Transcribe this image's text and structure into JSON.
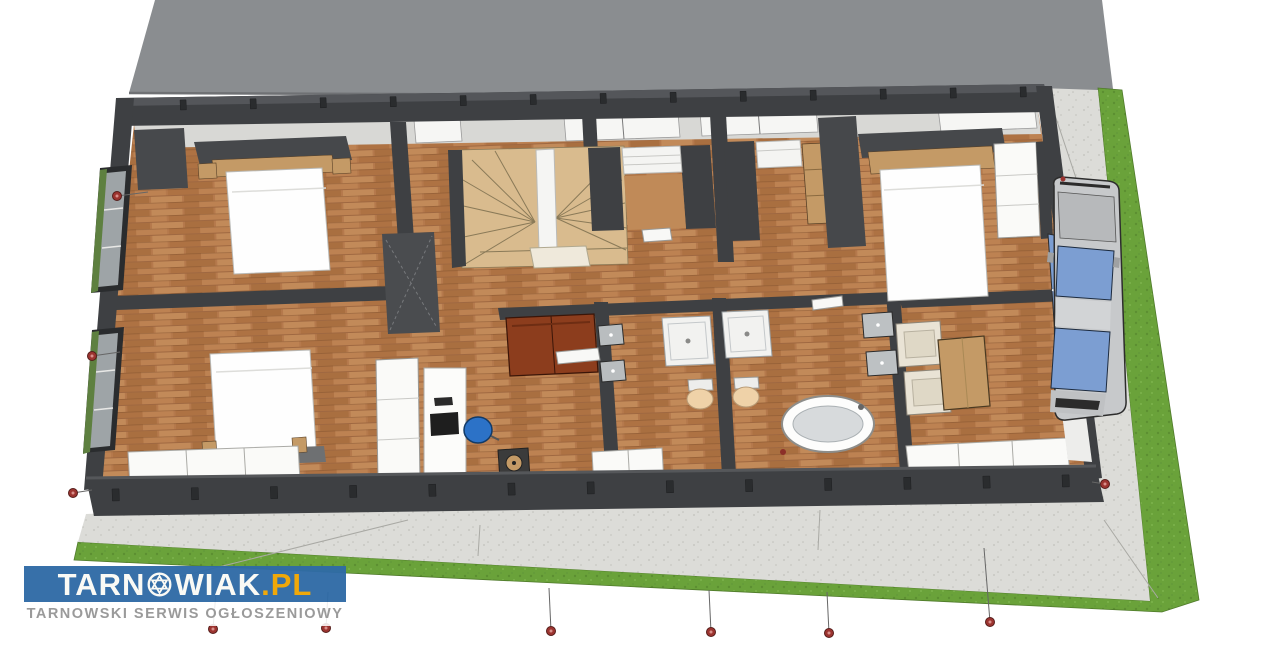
{
  "watermark": {
    "site_name_prefix": "TARN",
    "site_name_suffix": "WIAK",
    "site_dot": ".",
    "site_tld": "PL",
    "tagline": "TARNOWSKI SERWIS OGŁOSZENIOWY",
    "colors": {
      "banner": "#2F6BA6",
      "brand_text": "#FAFAF5",
      "tld": "#F0A500",
      "subtitle_text": "#9A9A9A"
    }
  },
  "scene": {
    "description": "3D cutaway floor-plan render of a single-storey house interior with furniture, winder staircase, two bathrooms, car on gravel driveway and lawn strips",
    "palette": {
      "roof": "#8A8D90",
      "wall": "#3E4043",
      "wall_top": "#54565A",
      "inner_face": "#D8D8D5",
      "floor_wood": "#B5794C",
      "floor_wood_light": "#C08A58",
      "grass": "#6AA23A",
      "paving": "#DCDCD8",
      "stairs": "#D9BB8E",
      "sofa": "#8C3D1D",
      "office_chair": "#2C72C7",
      "glass": "#7C9ED2",
      "furniture_wood": "#C49A66",
      "plant": "#5E8040",
      "white_furniture": "#FAFAF8",
      "marker": "#9C3430"
    },
    "objects": [
      "roof",
      "bedroom-bed-top-left",
      "bedroom-bed-bottom-left",
      "bedroom-bed-right",
      "winder-staircase",
      "walk-in-closet",
      "wardrobes",
      "sofa",
      "desk-with-monitor",
      "office-chair",
      "shower-tray-1",
      "shower-tray-2",
      "toilet-1",
      "toilet-2",
      "freestanding-bathtub",
      "wall-sinks",
      "armchairs",
      "coffee-table",
      "bench",
      "car-on-driveway",
      "gravel-paving",
      "lawn",
      "window-planters",
      "section-markers"
    ],
    "markers": {
      "count": 10,
      "points": [
        {
          "x": 117,
          "y": 196,
          "dx": 31,
          "dy": -4
        },
        {
          "x": 92,
          "y": 356,
          "dx": 28,
          "dy": -4
        },
        {
          "x": 73,
          "y": 493,
          "dx": 19,
          "dy": -3
        },
        {
          "x": 1105,
          "y": 484,
          "dx": -13,
          "dy": -2
        },
        {
          "x": 213,
          "y": 629,
          "dx": 3,
          "dy": -37
        },
        {
          "x": 326,
          "y": 628,
          "dx": 2,
          "dy": -36
        },
        {
          "x": 551,
          "y": 631,
          "dx": -2,
          "dy": -43
        },
        {
          "x": 711,
          "y": 632,
          "dx": -2,
          "dy": -42
        },
        {
          "x": 829,
          "y": 633,
          "dx": -2,
          "dy": -41
        },
        {
          "x": 990,
          "y": 622,
          "dx": -6,
          "dy": -74
        }
      ]
    }
  }
}
